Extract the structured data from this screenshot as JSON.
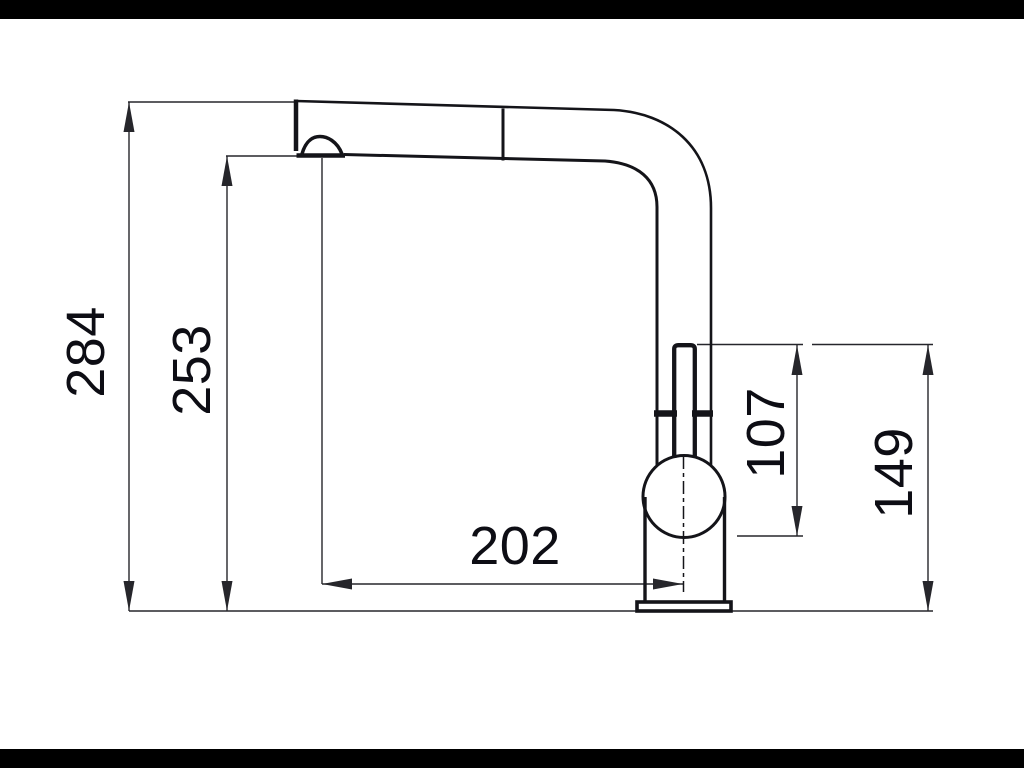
{
  "style": {
    "background": "#ffffff",
    "letterbox": "#000000",
    "line": "#141419",
    "dim_line": "#26262b",
    "text": "#0d0d14"
  },
  "drawing": {
    "subject": "Pull-out kitchen mixer tap, side elevation technical drawing",
    "dimensions": {
      "overall_height": {
        "label": "284",
        "orientation": "vertical"
      },
      "outlet_height": {
        "label": "253",
        "orientation": "vertical"
      },
      "spout_reach": {
        "label": "202",
        "orientation": "horizontal"
      },
      "handle_to_cartridge": {
        "label": "107",
        "orientation": "vertical"
      },
      "handle_to_base": {
        "label": "149",
        "orientation": "vertical"
      }
    }
  }
}
